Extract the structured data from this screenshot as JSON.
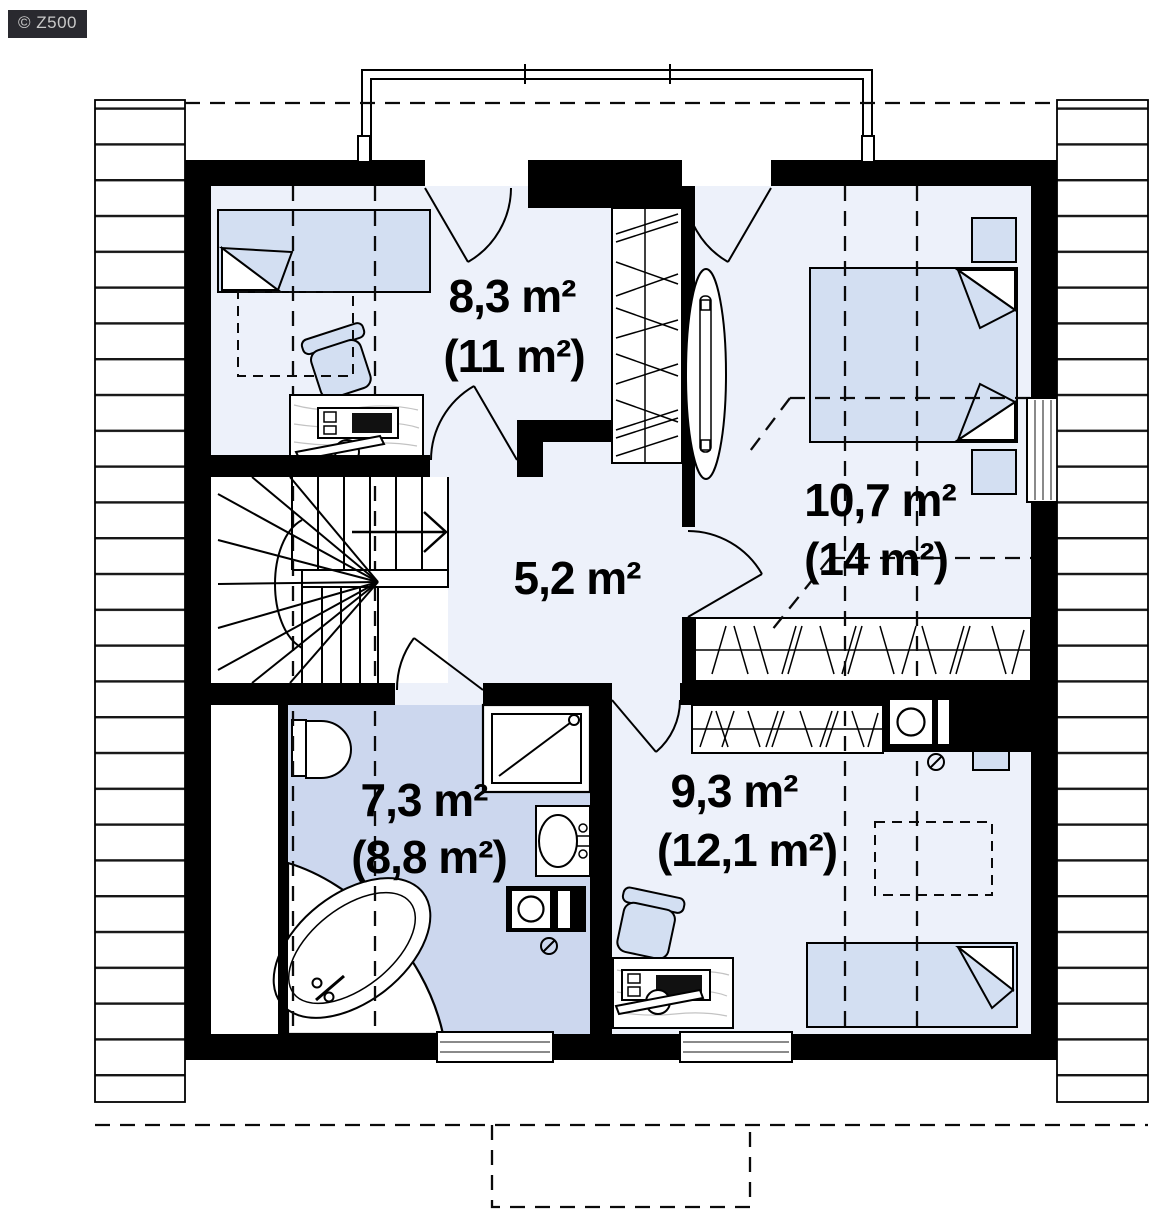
{
  "watermark": {
    "text": "© Z500"
  },
  "rooms": [
    {
      "id": "bedroom-upper-left",
      "area": "8,3 m²",
      "area_total": "(11 m²)"
    },
    {
      "id": "bedroom-right",
      "area": "10,7 m²",
      "area_total": "(14 m²)"
    },
    {
      "id": "hall",
      "area": "5,2 m²"
    },
    {
      "id": "bathroom",
      "area": "7,3 m²",
      "area_total": "(8,8 m²)"
    },
    {
      "id": "bedroom-lower-right",
      "area": "9,3 m²",
      "area_total": "(12,1 m²)"
    }
  ],
  "fixtures": {
    "bathroom": [
      "toilet",
      "corner-bathtub",
      "shower-cabin",
      "washbasin",
      "washing-machine"
    ],
    "bedroom_upper_left": [
      "single-bed",
      "desk",
      "desk-chair",
      "wardrobe"
    ],
    "bedroom_right": [
      "double-bed",
      "nightstand",
      "nightstand",
      "wardrobe",
      "tall-mirror"
    ],
    "bedroom_lower_right": [
      "single-bed",
      "desk",
      "desk-chair",
      "wardrobe",
      "washing-machine",
      "roof-window"
    ],
    "hall": [
      "winder-staircase"
    ],
    "exterior": [
      "balcony-railing",
      "roof-slope-left",
      "roof-slope-right",
      "porch-outline"
    ]
  },
  "colors": {
    "wall": "#000000",
    "floor": "#edf1fa",
    "bathroom_floor": "#ccd7ee",
    "furniture": "#d3dff2",
    "glazing": "#8a8a8a",
    "watermark_bg": "#29292f",
    "watermark_text": "#c9c9c9"
  }
}
